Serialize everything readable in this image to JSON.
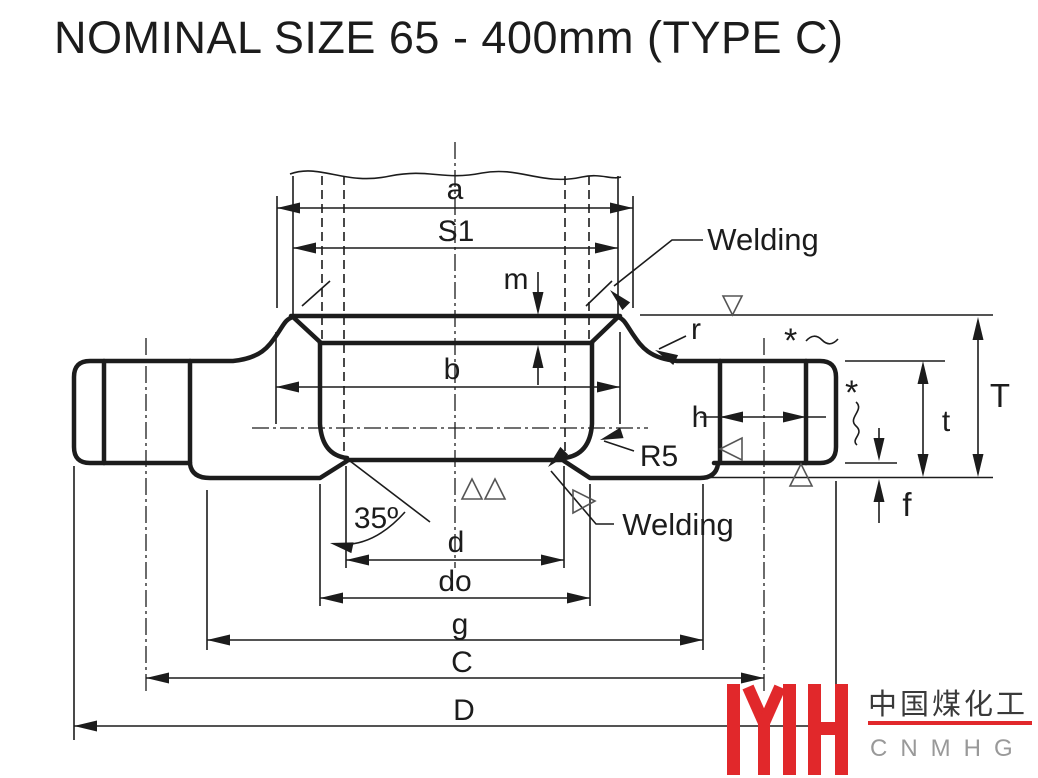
{
  "title": "NOMINAL SIZE 65 - 400mm (TYPE C)",
  "labels": {
    "a": "a",
    "s1": "S1",
    "m": "m",
    "b": "b",
    "h": "h",
    "r": "r",
    "r5": "R5",
    "angle": "35º",
    "d": "d",
    "do": "do",
    "g": "g",
    "c": "C",
    "d_cap": "D",
    "t_cap": "T",
    "t": "t",
    "f": "f",
    "welding_top": "Welding",
    "welding_bottom": "Welding",
    "star_top": "*",
    "star_right": "*"
  },
  "logo": {
    "cn": "中国煤化工",
    "en": "CNMHG"
  },
  "colors": {
    "section_fill": "#7D96C4",
    "logo_red": "#E1282B",
    "line": "#1C1C1C",
    "logo_gray": "#999999"
  }
}
